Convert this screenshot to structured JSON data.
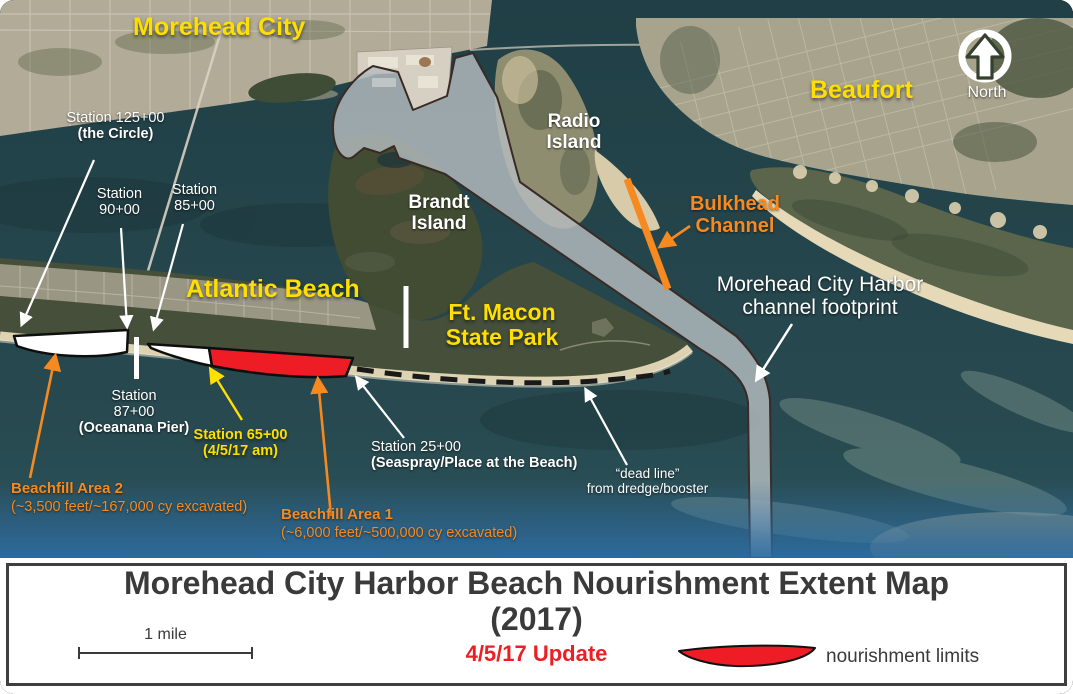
{
  "map": {
    "cities": {
      "morehead_city": "Morehead City",
      "beaufort": "Beaufort",
      "atlantic_beach": "Atlantic Beach"
    },
    "north_label": "North",
    "islands": {
      "radio_l1": "Radio",
      "radio_l2": "Island",
      "brandt_l1": "Brandt",
      "brandt_l2": "Island",
      "ft_macon_l1": "Ft. Macon",
      "ft_macon_l2": "State Park"
    },
    "channels": {
      "bulkhead_l1": "Bulkhead",
      "bulkhead_l2": "Channel",
      "harbor_l1": "Morehead City Harbor",
      "harbor_l2": "channel footprint",
      "dead_line_l1": "“dead line”",
      "dead_line_l2": "from dredge/booster"
    },
    "stations": {
      "s125_l1": "Station 125+00",
      "s125_l2": "(the Circle)",
      "s90_l1": "Station",
      "s90_l2": "90+00",
      "s85_l1": "Station",
      "s85_l2": "85+00",
      "s87_l1": "Station",
      "s87_l2": "87+00",
      "s87_l3": "(Oceanana Pier)",
      "s65_l1": "Station 65+00",
      "s65_l2": "(4/5/17 am)",
      "s25_l1": "Station 25+00",
      "s25_l2": "(Seaspray/Place at the Beach)"
    },
    "beachfills": {
      "area2_l1": "Beachfill Area 2",
      "area2_l2": "(~3,500 feet/~167,000 cy excavated)",
      "area1_l1": "Beachfill Area 1",
      "area1_l2": "(~6,000 feet/~500,000 cy excavated)"
    }
  },
  "footer": {
    "title_l1": "Morehead City Harbor Beach Nourishment Extent Map",
    "title_l2": "(2017)",
    "update": "4/5/17 Update",
    "scale_label": "1 mile",
    "legend_label": "nourishment limits"
  },
  "colors": {
    "label_yellow": "#FFDF00",
    "label_orange": "#F6891F",
    "nourishment_red": "#EE1C25",
    "update_red": "#EC2024",
    "title_gray": "#3A3A3A",
    "channel_footprint_gray": "#B6BDC0"
  }
}
